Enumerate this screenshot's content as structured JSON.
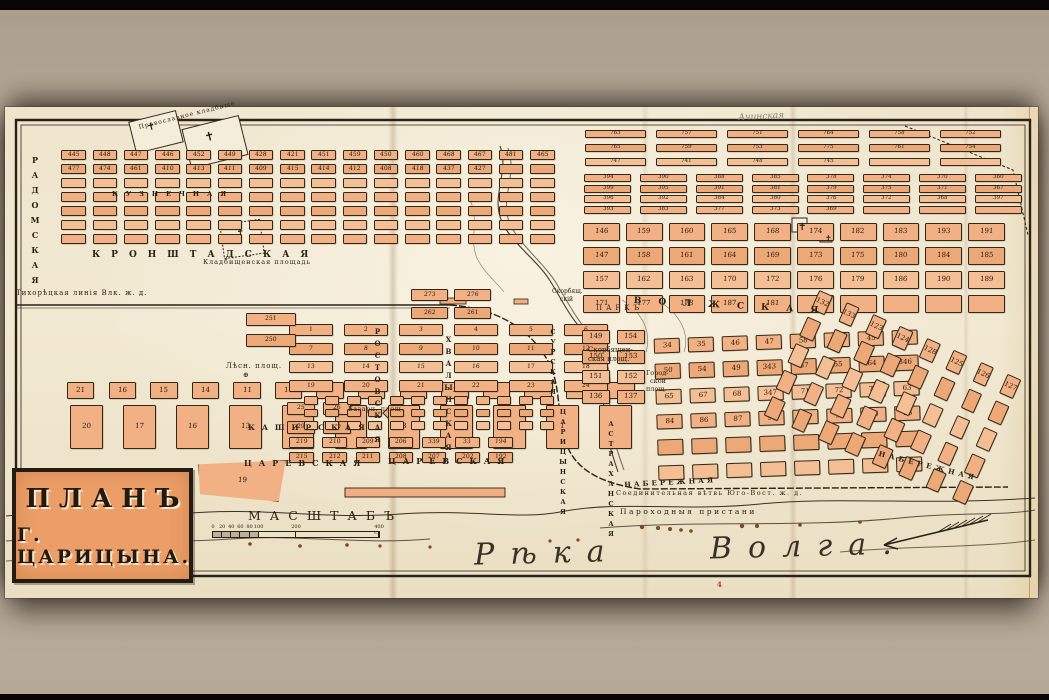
{
  "title": {
    "line1": "ПЛАНЪ",
    "line2": "Г. ЦАРИЦЫНА."
  },
  "river": {
    "name": "Рѣка Волга."
  },
  "scale": {
    "title": "МАСШТАБЪ",
    "unit_note": "саженей",
    "ticks": [
      [
        "0",
        0
      ],
      [
        "20",
        0.055
      ],
      [
        "40",
        0.11
      ],
      [
        "60",
        0.165
      ],
      [
        "80",
        0.22
      ],
      [
        "100",
        0.275
      ],
      [
        "200",
        0.5
      ],
      [
        "400 с.",
        1
      ]
    ]
  },
  "colors": {
    "background": "#b9ab99",
    "paper": "#f0e6cf",
    "ink": "#2b2216",
    "block_fill": "#f0b083",
    "block_stroke": "#34281a",
    "cartouche_fill": "#eb9e67",
    "red_accent": "#c03a2e",
    "pencil": "#8b8274",
    "water_ink": "#4a3c2c"
  },
  "texts": [
    {
      "t": "КРОНШТАДСКАЯ",
      "x": 92,
      "y": 250,
      "fs": 9,
      "ls": 11,
      "cls": "street"
    },
    {
      "t": "КУЗНЕЧНАЯ",
      "x": 112,
      "y": 190,
      "fs": 6.5,
      "ls": 8,
      "cls": "street"
    },
    {
      "t": "РАДОМСКАЯ",
      "x": 30,
      "y": 155,
      "fs": 8,
      "ls": 5,
      "v": true,
      "cls": "street"
    },
    {
      "t": "ВОЛЖСКАЯ",
      "x": 634,
      "y": 296,
      "fs": 9,
      "ls": 17,
      "rot": 3,
      "cls": "street"
    },
    {
      "t": "НАБЕРЕЖНАЯ",
      "x": 880,
      "y": 449,
      "fs": 7,
      "ls": 4,
      "rot": 14,
      "cls": "street"
    },
    {
      "t": "НАБЕРЕЖНАЯ",
      "x": 624,
      "y": 480,
      "fs": 7,
      "ls": 3,
      "rot": -3,
      "cls": "street"
    },
    {
      "t": "ЦАРЕВСКАЯ",
      "x": 244,
      "y": 458,
      "fs": 8,
      "ls": 7,
      "cls": "street"
    },
    {
      "t": "ЦАРЕВСКАЯ",
      "x": 388,
      "y": 456,
      "fs": 8,
      "ls": 7,
      "cls": "street"
    },
    {
      "t": "КАШИРСКАЯ",
      "x": 248,
      "y": 423,
      "fs": 7.5,
      "ls": 7,
      "cls": "street"
    },
    {
      "t": "РОСТОВСКАЯ",
      "x": 373,
      "y": 327,
      "fs": 7,
      "ls": 3,
      "v": true,
      "cls": "street"
    },
    {
      "t": "ХВАЛЫНСКАЯ",
      "x": 444,
      "y": 335,
      "fs": 7,
      "ls": 3,
      "v": true,
      "cls": "street"
    },
    {
      "t": "ЦАРИЦЫНСКАЯ",
      "x": 559,
      "y": 408,
      "fs": 6.5,
      "ls": 2,
      "v": true,
      "cls": "street"
    },
    {
      "t": "АСТРАХАНСКАЯ",
      "x": 607,
      "y": 420,
      "fs": 6.5,
      "ls": 2,
      "v": true,
      "cls": "street"
    },
    {
      "t": "СУРСКАЯ",
      "x": 549,
      "y": 328,
      "fs": 6.5,
      "ls": 2,
      "v": true,
      "cls": "street"
    },
    {
      "t": "Кладбищенская площадь",
      "x": 203,
      "y": 258,
      "fs": 6.5,
      "ls": 1,
      "cls": "place"
    },
    {
      "t": "Православное кладбище",
      "x": 138,
      "y": 124,
      "fs": 6,
      "ls": 1,
      "rot": -14,
      "cls": "place"
    },
    {
      "t": "Лѣсн. площ.",
      "x": 226,
      "y": 362,
      "fs": 7,
      "ls": 1,
      "cls": "place"
    },
    {
      "t": "⊕",
      "x": 243,
      "y": 371,
      "fs": 7,
      "cls": "place"
    },
    {
      "t": "Базарн. площ.",
      "x": 348,
      "y": 405,
      "fs": 6.5,
      "ls": 0.5,
      "cls": "place"
    },
    {
      "t": "Скорбящен-",
      "x": 588,
      "y": 346,
      "fs": 7,
      "cls": "place"
    },
    {
      "t": "ская площ.",
      "x": 588,
      "y": 355,
      "fs": 7,
      "cls": "place"
    },
    {
      "t": "Скорбящ.",
      "x": 552,
      "y": 288,
      "fs": 6,
      "cls": "place"
    },
    {
      "t": "скій",
      "x": 560,
      "y": 296,
      "fs": 6,
      "cls": "place"
    },
    {
      "t": "ПАРКЪ",
      "x": 596,
      "y": 304,
      "fs": 7,
      "ls": 4,
      "cls": "place"
    },
    {
      "t": "Город-",
      "x": 646,
      "y": 369,
      "fs": 6.5,
      "cls": "place"
    },
    {
      "t": "ской",
      "x": 650,
      "y": 377,
      "fs": 6.5,
      "cls": "place"
    },
    {
      "t": "площ.",
      "x": 646,
      "y": 385,
      "fs": 6.5,
      "cls": "place"
    },
    {
      "t": "Тихорѣцкая линія Влк. ж. д.",
      "x": 16,
      "y": 289,
      "fs": 7,
      "ls": 1,
      "cls": "rail"
    },
    {
      "t": "Соединительная вѣтвь Юго-Вост. ж. д.",
      "x": 616,
      "y": 489,
      "fs": 6.5,
      "ls": 1.5,
      "cls": "rail"
    },
    {
      "t": "Пароходныя пристани",
      "x": 620,
      "y": 507,
      "fs": 7.5,
      "ls": 2.5,
      "cls": "rail"
    },
    {
      "t": "Ачинская",
      "x": 738,
      "y": 113,
      "fs": 9,
      "rot": -3,
      "cls": "pencil"
    },
    {
      "t": "4",
      "x": 717,
      "y": 580,
      "fs": 7,
      "cls": "red"
    },
    {
      "t": "✝",
      "x": 146,
      "y": 123,
      "fs": 10,
      "rot": -14,
      "cls": "cross"
    },
    {
      "t": "✝",
      "x": 203,
      "y": 131,
      "fs": 12,
      "rot": -14,
      "cls": "cross"
    },
    {
      "t": "✝",
      "x": 236,
      "y": 229,
      "fs": 9,
      "rot": -8,
      "cls": "cross"
    },
    {
      "t": "✝",
      "x": 798,
      "y": 222,
      "fs": 10,
      "cls": "cross"
    },
    {
      "t": "✝",
      "x": 825,
      "y": 234,
      "fs": 8,
      "cls": "cross"
    }
  ],
  "districts": [
    {
      "id": "district-nw",
      "x": 58,
      "y": 148,
      "w": 500,
      "h": 98,
      "rows": 7,
      "cols": 16,
      "fx": 0.78,
      "fy": 0.72,
      "numbers": [
        "445",
        "448",
        "447",
        "446",
        "452",
        "449",
        "428",
        "421",
        "451",
        "459",
        "450",
        "460",
        "468",
        "467",
        "481",
        "465",
        "477",
        "474",
        "461",
        "410",
        "413",
        "411",
        "409",
        "415",
        "414",
        "412",
        "408",
        "418",
        "437",
        "427"
      ]
    },
    {
      "id": "district-ne-upper",
      "x": 580,
      "y": 127,
      "w": 426,
      "h": 42,
      "rows": 3,
      "cols": 6,
      "fx": 0.86,
      "fy": 0.62,
      "numbers": [
        "763",
        "757",
        "751",
        "764",
        "758",
        "752",
        "765",
        "759",
        "753",
        "775",
        "761",
        "754",
        "747",
        "741",
        "748",
        "745"
      ]
    },
    {
      "id": "district-ne-mid",
      "x": 580,
      "y": 173,
      "w": 446,
      "h": 42,
      "rows": 4,
      "cols": 8,
      "fx": 0.84,
      "fy": 0.72,
      "numbers": [
        "394",
        "390",
        "388",
        "385",
        "378",
        "374",
        "370",
        "360",
        "399",
        "395",
        "391",
        "381",
        "379",
        "375",
        "371",
        "367",
        "396",
        "392",
        "384",
        "380",
        "376",
        "372",
        "368",
        "397",
        "393",
        "383",
        "377",
        "373",
        "369"
      ]
    },
    {
      "id": "district-ne-main",
      "x": 580,
      "y": 220,
      "w": 428,
      "h": 96,
      "rows": 4,
      "cols": 10,
      "fx": 0.86,
      "fy": 0.72,
      "numbers": [
        "146",
        "159",
        "160",
        "165",
        "168",
        "174",
        "182",
        "183",
        "193",
        "191",
        "147",
        "158",
        "161",
        "164",
        "169",
        "173",
        "175",
        "180",
        "184",
        "185",
        "157",
        "162",
        "163",
        "170",
        "172",
        "176",
        "179",
        "186",
        "190",
        "189",
        "171",
        "177",
        "178",
        "187",
        "181"
      ]
    },
    {
      "id": "district-lumber-north",
      "x": 60,
      "y": 382,
      "w": 582,
      "h": 17,
      "rows": 1,
      "cols": 14,
      "fx": 0.66,
      "fy": 0.95,
      "numbers": [
        "21",
        "16",
        "15",
        "14",
        "11",
        "10",
        "7",
        "6",
        "3",
        "2"
      ]
    },
    {
      "id": "district-lumber-south",
      "x": 60,
      "y": 403,
      "w": 582,
      "h": 48,
      "rows": 1,
      "cols": 11,
      "fx": 0.62,
      "fy": 0.92,
      "numbers": [
        "20",
        "17",
        "16",
        "13",
        "12",
        "9",
        "8",
        "5",
        "4",
        "1"
      ]
    },
    {
      "id": "district-lumber-wedge",
      "x": 196,
      "y": 458,
      "w": 92,
      "h": 46,
      "rows": 1,
      "cols": 1,
      "fx": 0.95,
      "fy": 0.9,
      "shape": "wedge",
      "numbers": [
        "19"
      ]
    },
    {
      "id": "district-center",
      "x": 283,
      "y": 321,
      "w": 330,
      "h": 74,
      "rows": 4,
      "cols": 6,
      "fx": 0.8,
      "fy": 0.66,
      "numbers": [
        "1",
        "2",
        "3",
        "4",
        "5",
        "6",
        "7",
        "8",
        "9",
        "10",
        "11",
        "12",
        "13",
        "14",
        "15",
        "16",
        "17",
        "18",
        "19",
        "20",
        "21",
        "22",
        "23",
        "24"
      ]
    },
    {
      "id": "district-center-south",
      "x": 283,
      "y": 399,
      "w": 72,
      "h": 38,
      "rows": 2,
      "cols": 2,
      "fx": 0.8,
      "fy": 0.66,
      "numbers": [
        "25",
        "26",
        "29",
        "30"
      ]
    },
    {
      "id": "district-250",
      "x": 243,
      "y": 309,
      "w": 56,
      "h": 42,
      "rows": 2,
      "cols": 1,
      "fx": 0.9,
      "fy": 0.6,
      "numbers": [
        "251",
        "250"
      ]
    },
    {
      "id": "district-260",
      "x": 408,
      "y": 286,
      "w": 86,
      "h": 36,
      "rows": 2,
      "cols": 2,
      "fx": 0.85,
      "fy": 0.62,
      "numbers": [
        "273",
        "276",
        "262",
        "261"
      ]
    },
    {
      "id": "district-mid-dense",
      "x": 300,
      "y": 394,
      "w": 258,
      "h": 38,
      "rows": 3,
      "cols": 12,
      "fx": 0.64,
      "fy": 0.7,
      "numbers": []
    },
    {
      "id": "district-200s",
      "x": 285,
      "y": 435,
      "w": 232,
      "h": 30,
      "rows": 2,
      "cols": 7,
      "fx": 0.74,
      "fy": 0.72,
      "numbers": [
        "219",
        "210",
        "209",
        "206",
        "339",
        "33",
        "194",
        "215",
        "212",
        "211",
        "208",
        "207",
        "202",
        "192"
      ]
    },
    {
      "id": "district-150s",
      "x": 578,
      "y": 327,
      "w": 70,
      "h": 80,
      "rows": 4,
      "cols": 2,
      "fx": 0.8,
      "fy": 0.74,
      "numbers": [
        "149",
        "154",
        "150",
        "153",
        "151",
        "152",
        "136",
        "137"
      ]
    },
    {
      "id": "district-south",
      "x": 652,
      "y": 329,
      "w": 272,
      "h": 152,
      "rows": 6,
      "cols": 8,
      "fx": 0.78,
      "fy": 0.6,
      "rot": -2,
      "numbers": [
        "34",
        "35",
        "46",
        "47",
        "58",
        "36",
        "45",
        "52",
        "50",
        "54",
        "49",
        "343",
        "57",
        "55",
        "64",
        "346",
        "65",
        "67",
        "68",
        "347",
        "71",
        "72",
        "73",
        "63",
        "84",
        "86",
        "87",
        "90",
        "92",
        "94",
        "96",
        "33"
      ]
    },
    {
      "id": "district-se",
      "x": 775,
      "y": 325,
      "w": 235,
      "h": 145,
      "rows": 5,
      "cols": 8,
      "fx": 0.5,
      "fy": 0.74,
      "rot": 24,
      "numbers": [
        "132",
        "133",
        "123",
        "124",
        "128",
        "125",
        "126",
        "127"
      ]
    }
  ]
}
